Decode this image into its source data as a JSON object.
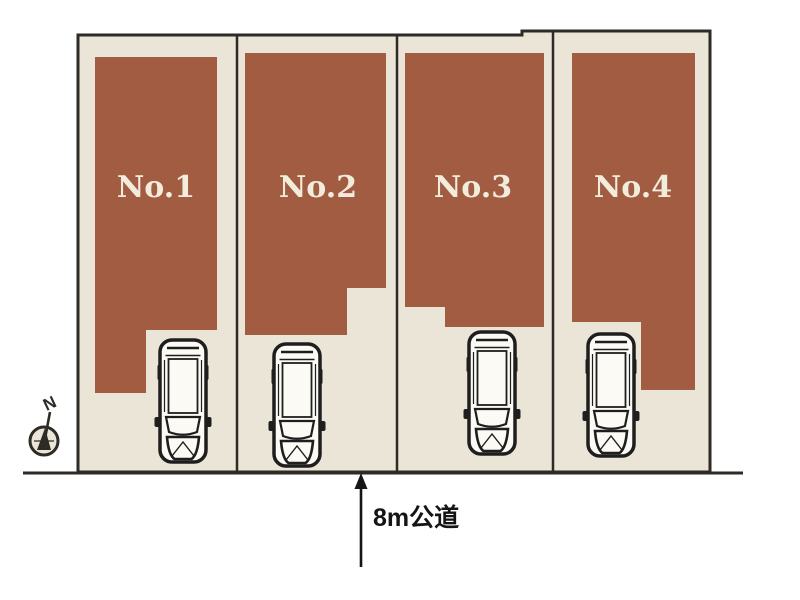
{
  "plan": {
    "lots": [
      {
        "label": "No.1"
      },
      {
        "label": "No.2"
      },
      {
        "label": "No.3"
      },
      {
        "label": "No.4"
      }
    ],
    "road_label": "8m公道",
    "compass_label": "N"
  },
  "icons": {
    "car": "car-top-view",
    "compass": "north-arrow",
    "road_arrow": "arrow-up"
  },
  "colors": {
    "background": "#ffffff",
    "lot_fill": "#ebe5d7",
    "building_fill": "#a25c41",
    "outline": "#2e2a25",
    "lot_label": "#f2ecdc",
    "car_fill": "#fbfaf4",
    "car_outline": "#1e1e1e",
    "text": "#151515"
  }
}
